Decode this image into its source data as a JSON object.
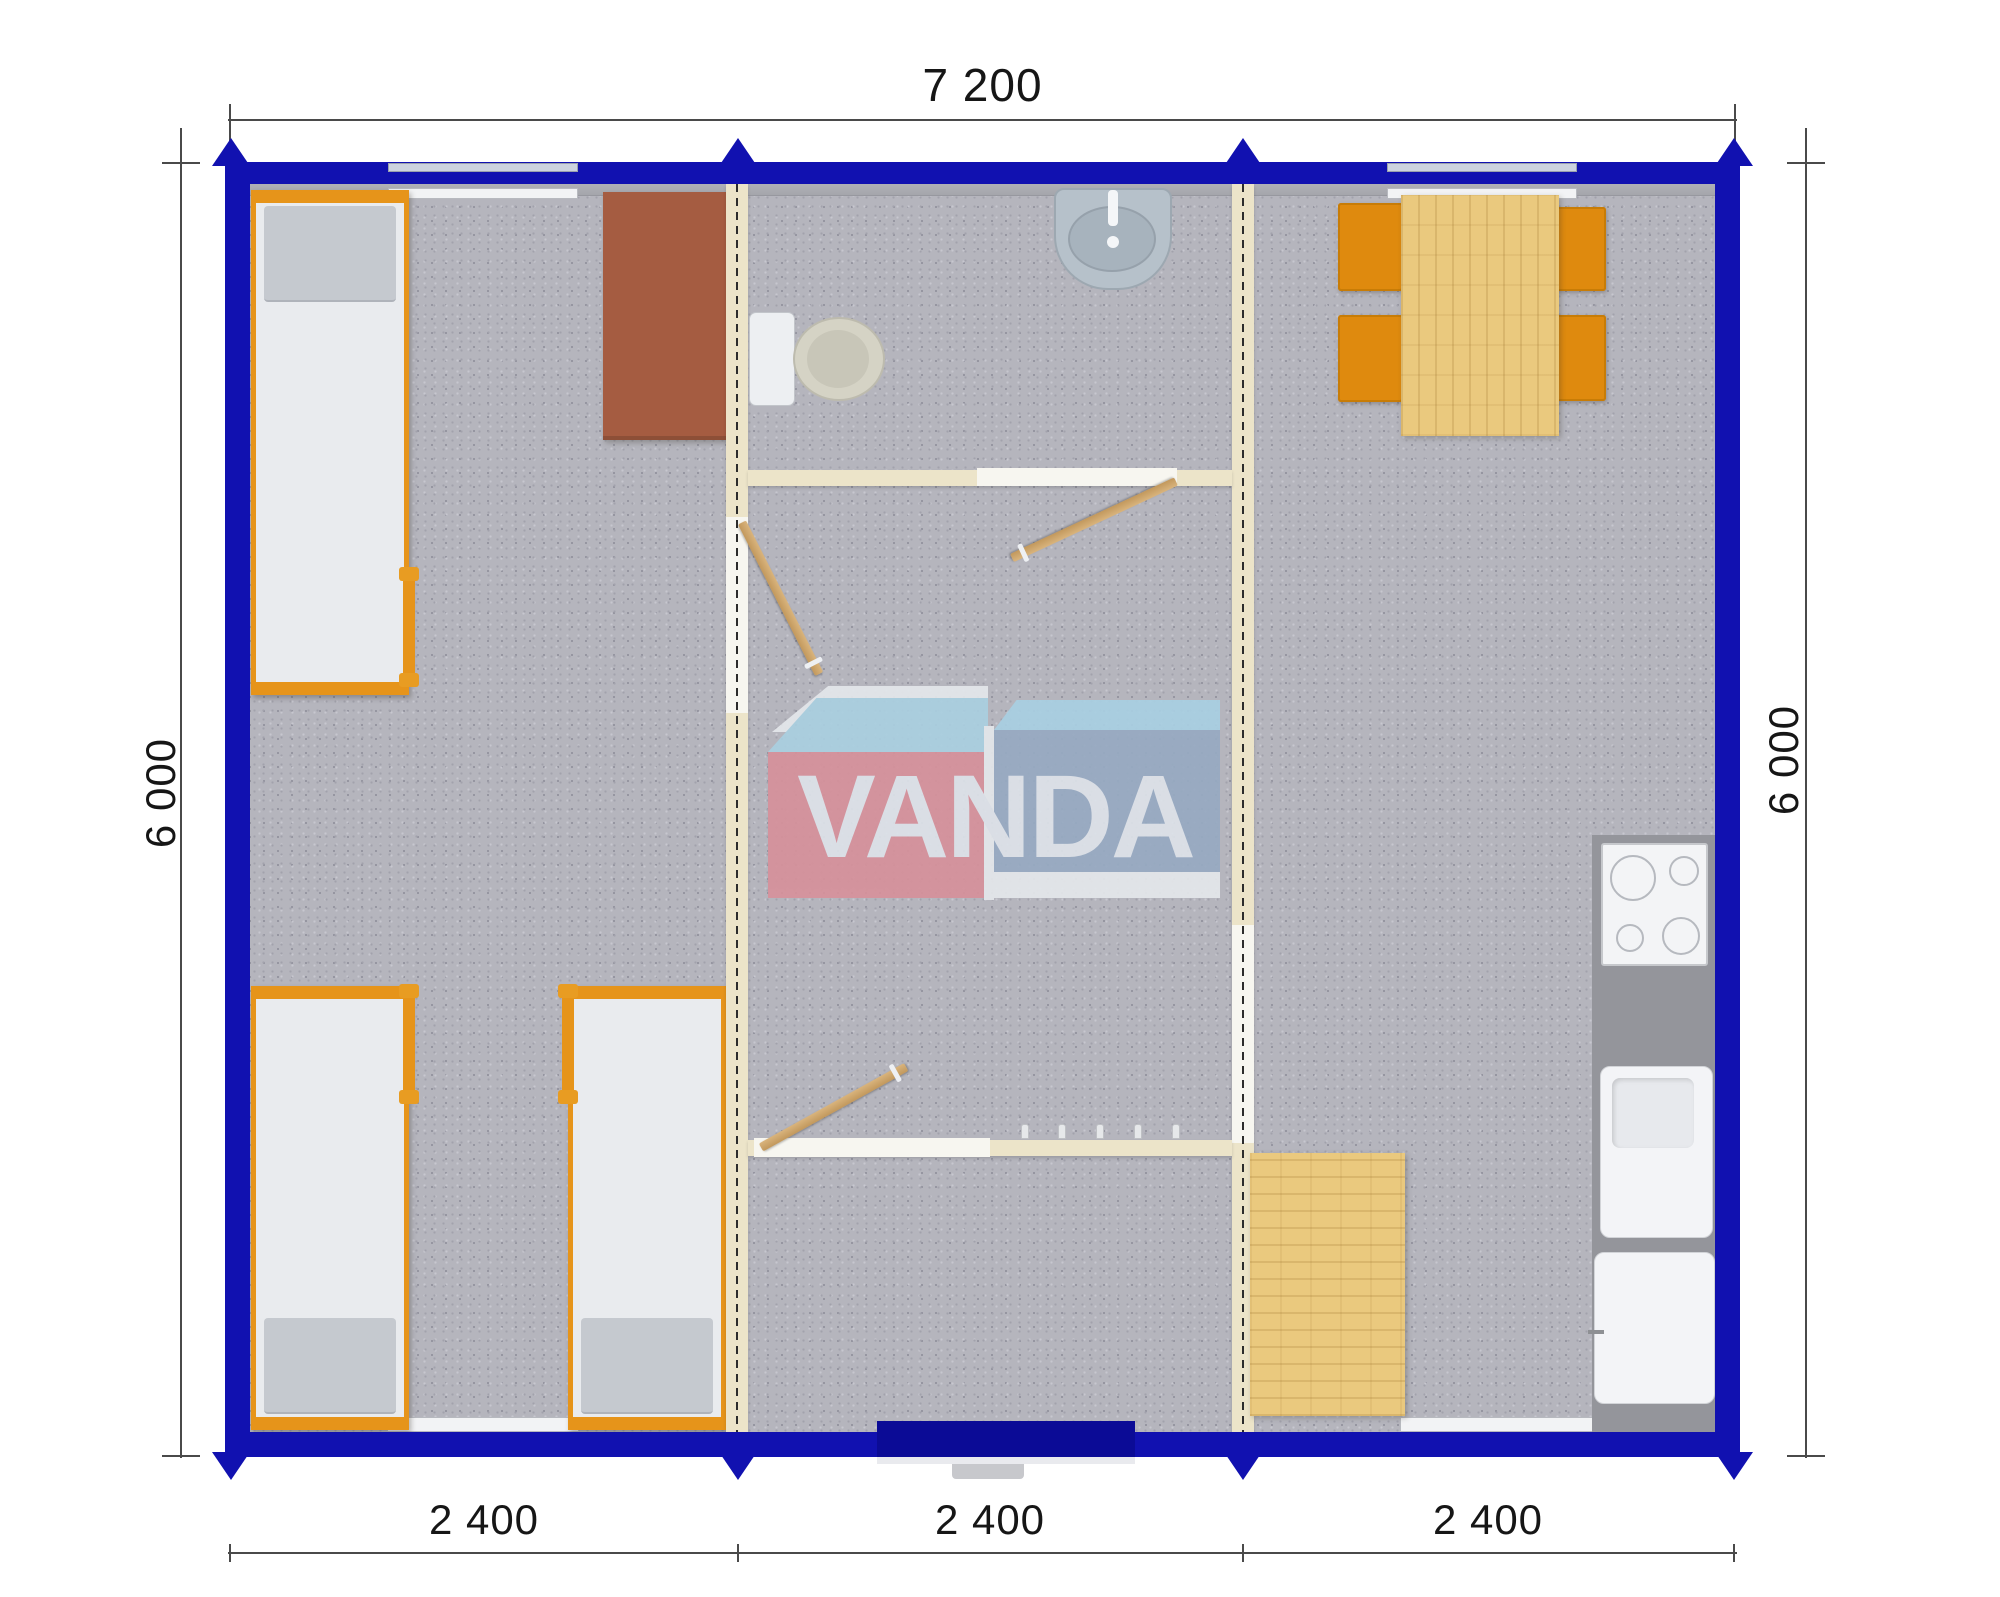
{
  "document": {
    "type": "floor-plan",
    "title": "Modular container building plan view"
  },
  "brand": {
    "name": "VANDA",
    "box_left_color": "#d6919b",
    "box_right_color": "#97aac2",
    "box_top_color": "#a9cfe2",
    "letter_color": "#dde2e9"
  },
  "dims": {
    "top": "7 200",
    "left": "6 000",
    "right": "6 000",
    "bottom": [
      "2 400",
      "2 400",
      "2 400"
    ]
  },
  "colors": {
    "outer_wall": "#1111b0",
    "entrance_door": "#0b0b96",
    "floor": "#b5b5bd",
    "partition_wall": "#ece4c9",
    "furniture_orange": "#e6941a",
    "wood": "#eac97e",
    "wardrobe_brown": "#a55c41",
    "kitchen_counter": "#94959b"
  },
  "furniture_icons": [
    "bed-icon",
    "bed-icon",
    "bed-icon",
    "wardrobe-icon",
    "toilet-icon",
    "washbasin-icon",
    "interior-door-icon",
    "interior-door-icon",
    "interior-door-icon",
    "dining-table-icon",
    "chair-icon",
    "chair-icon",
    "chair-icon",
    "chair-icon",
    "stove-icon",
    "kitchen-sink-icon",
    "kitchen-cabinet-icon",
    "side-table-icon",
    "coat-hooks-icon",
    "entrance-door-icon",
    "window-icon",
    "window-icon",
    "window-icon",
    "window-icon"
  ]
}
